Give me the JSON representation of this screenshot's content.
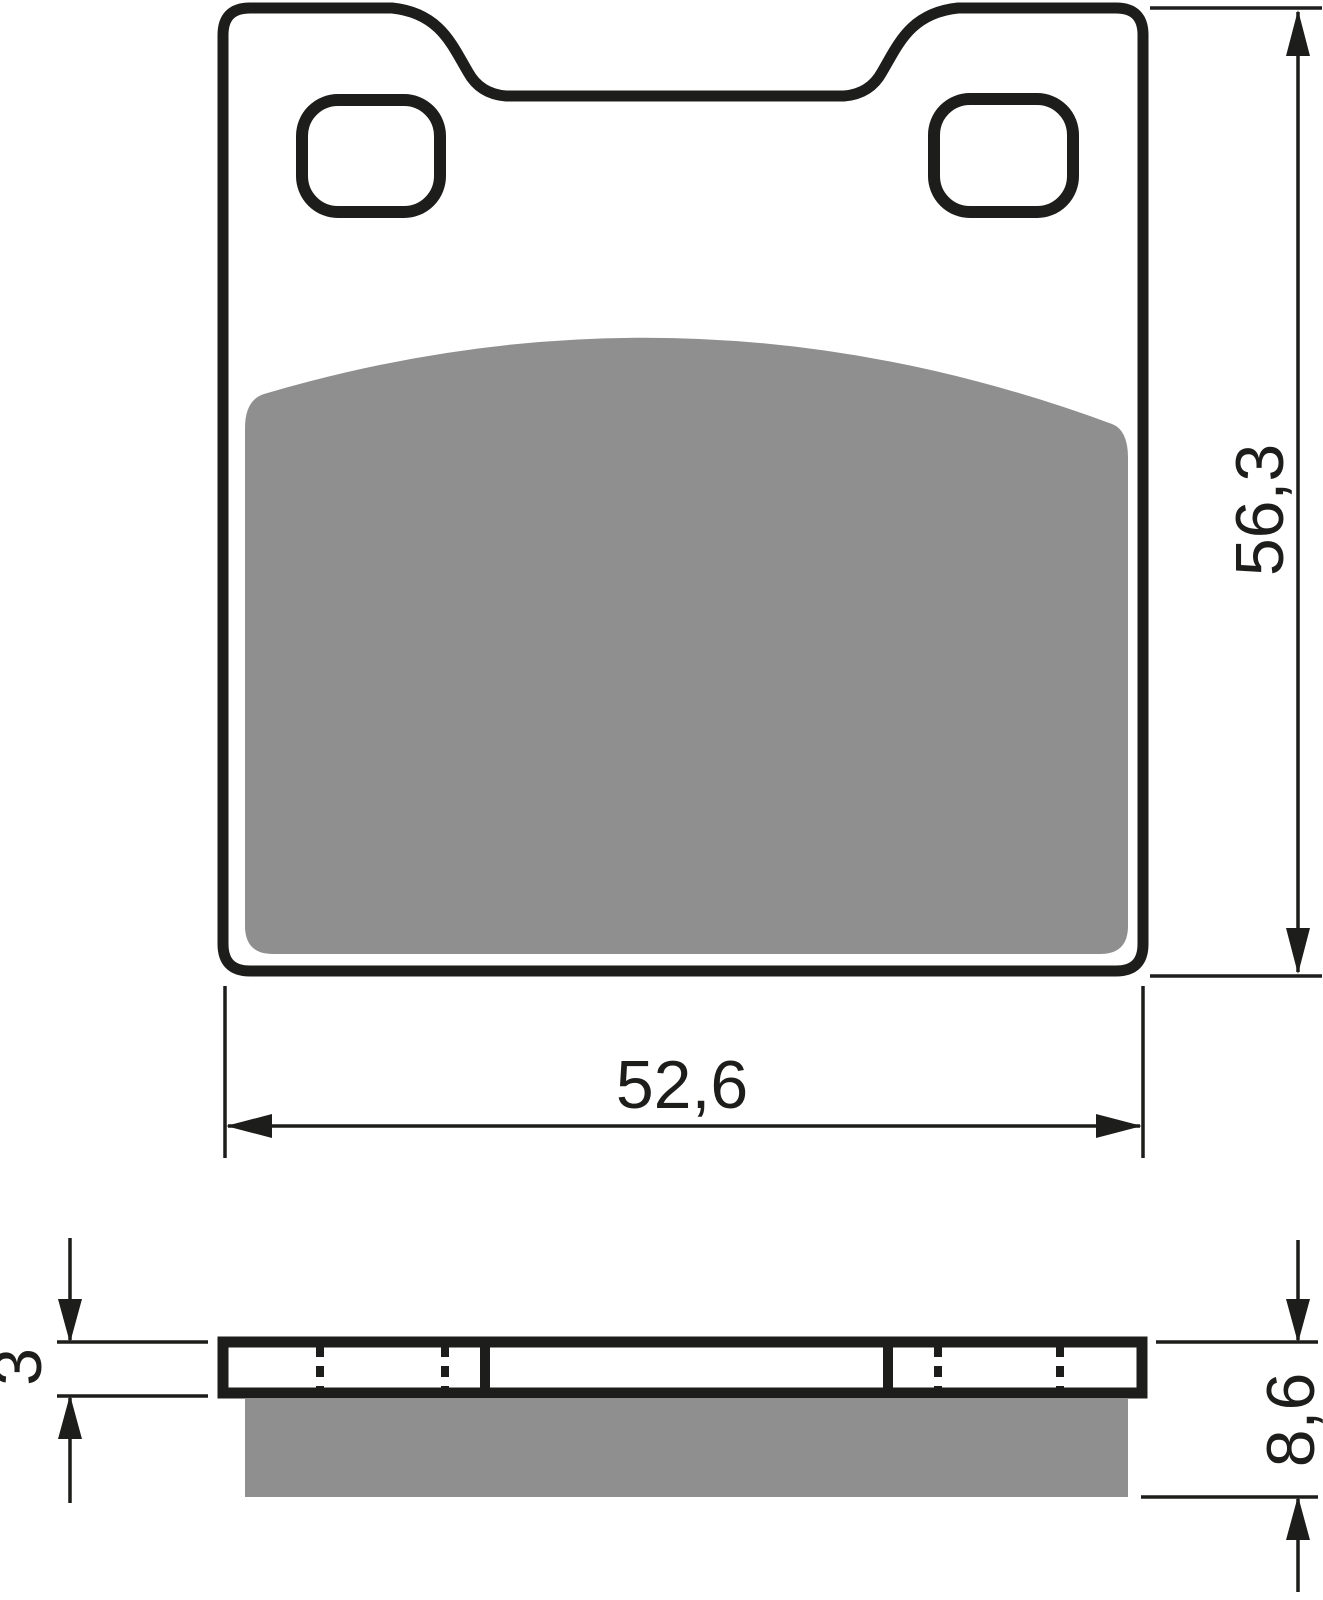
{
  "dimensions": {
    "width": "52,6",
    "height": "56,3",
    "backing_plate_thickness": "3",
    "total_thickness": "8,6"
  },
  "colors": {
    "line": "#1d1d1b",
    "friction_material": "#8f8f8f",
    "background": "#ffffff"
  }
}
